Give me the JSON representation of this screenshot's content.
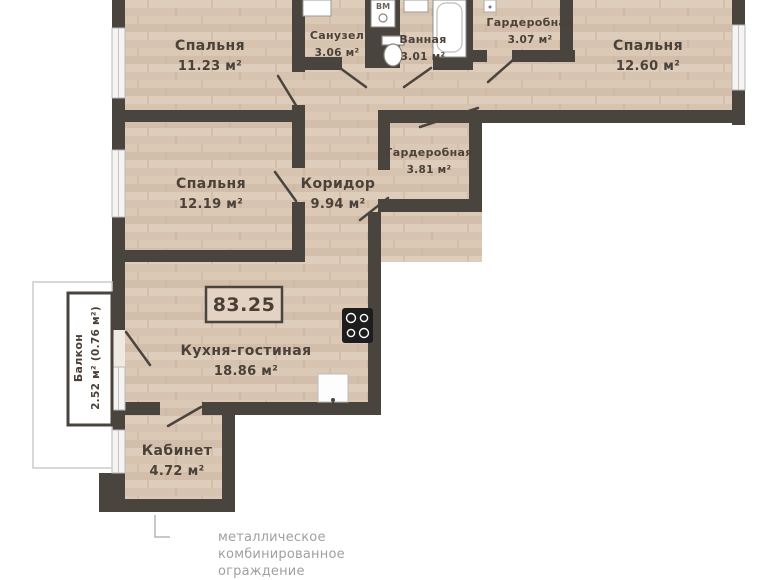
{
  "plan": {
    "total_area_badge": "83.25",
    "rooms": [
      {
        "id": "bedroom-1",
        "name": "Спальня",
        "area": "11.23 м²"
      },
      {
        "id": "sanuzel",
        "name": "Санузел",
        "area": "3.06 м²"
      },
      {
        "id": "bathroom",
        "name": "Ванная",
        "area": "3.01 м²"
      },
      {
        "id": "wardrobe-1",
        "name": "Гардеробная",
        "area": "3.07 м²"
      },
      {
        "id": "bedroom-2",
        "name": "Спальня",
        "area": "12.60 м²"
      },
      {
        "id": "wardrobe-2",
        "name": "Гардеробная",
        "area": "3.81 м²"
      },
      {
        "id": "bedroom-3",
        "name": "Спальня",
        "area": "12.19 м²"
      },
      {
        "id": "corridor",
        "name": "Коридор",
        "area": "9.94 м²"
      },
      {
        "id": "kitchen-living",
        "name": "Кухня-гостиная",
        "area": "18.86 м²"
      },
      {
        "id": "cabinet",
        "name": "Кабинет",
        "area": "4.72 м²"
      },
      {
        "id": "balcony",
        "name": "Балкон",
        "area": "2.52 м² (0.76 м²)"
      }
    ],
    "fixture_labels": {
      "vent_shaft": "ВМ"
    },
    "annotation": {
      "lines": [
        "металлическое",
        "комбинированное",
        "ограждение",
        "с глухой нижней частью"
      ]
    },
    "colors": {
      "wall": "#49443d",
      "floor": "#dccab7",
      "window": "#f5f4f2",
      "label_text": "#4a4138",
      "annotation_text": "#a0a0a0",
      "cooktop": "#1d1d1d"
    }
  }
}
